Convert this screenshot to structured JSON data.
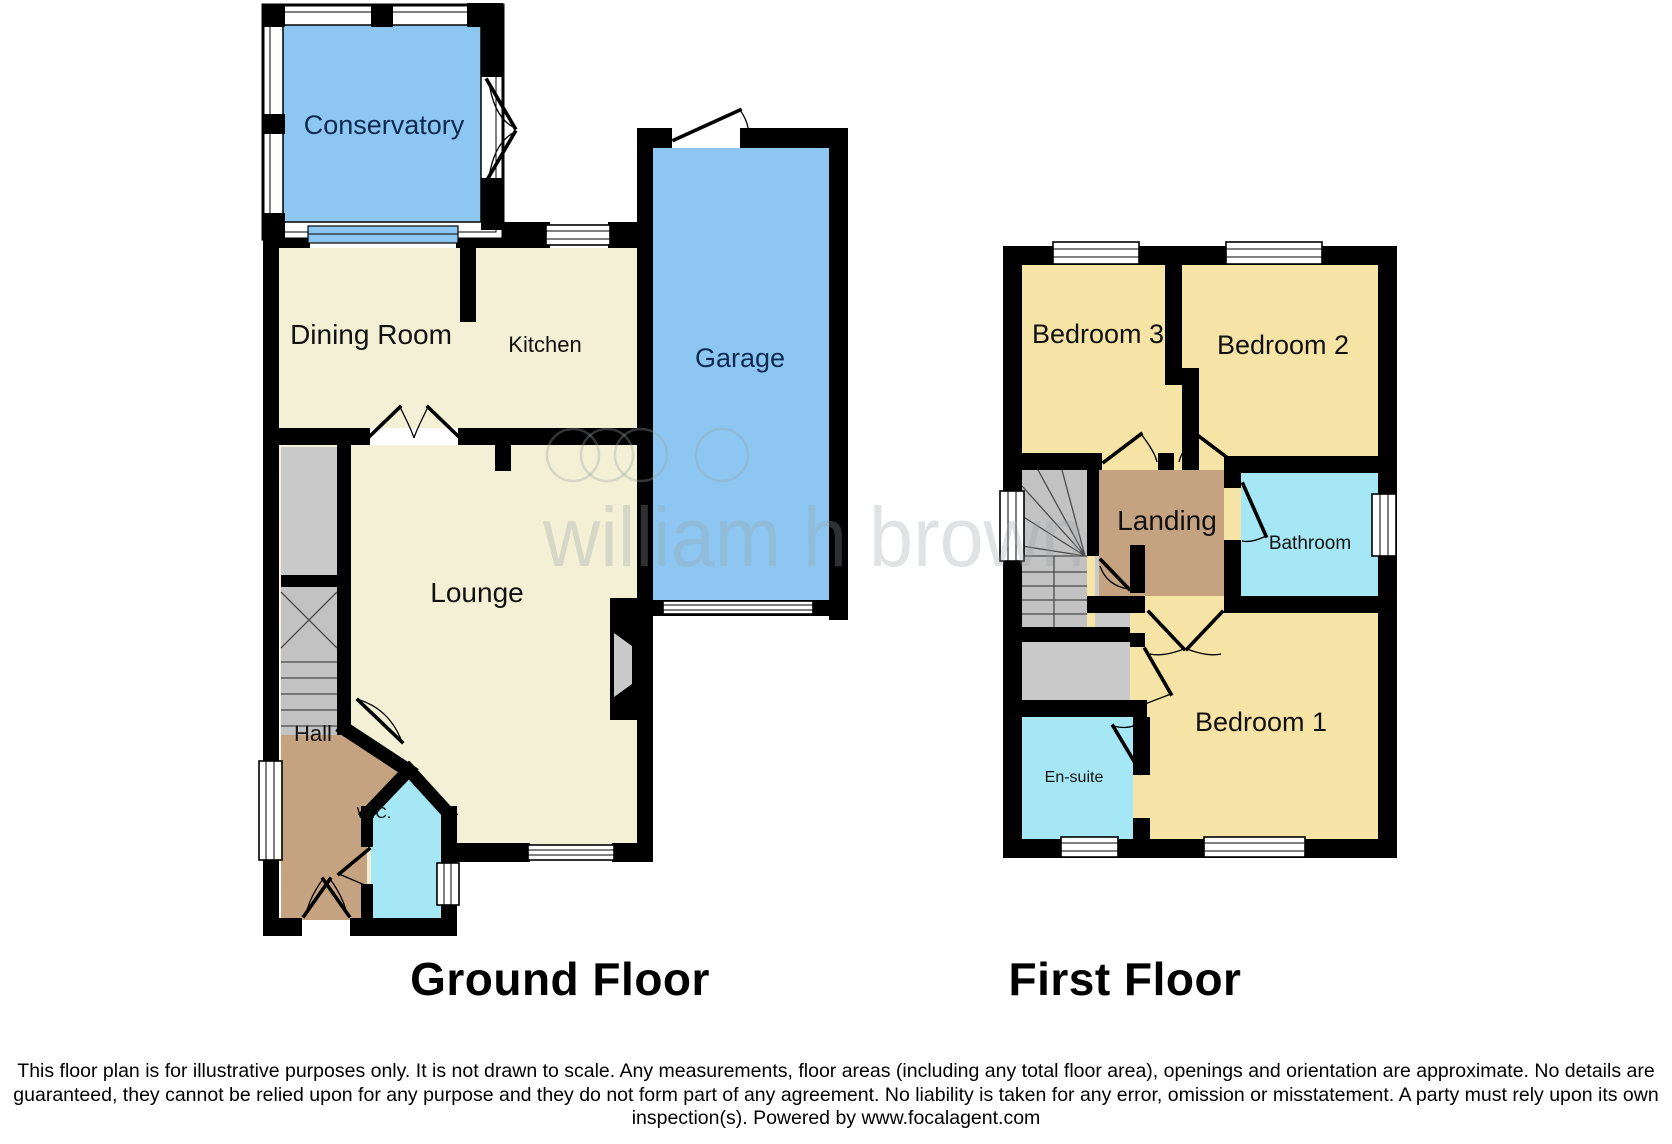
{
  "colors": {
    "room_blue": "#8dc7f1",
    "room_cream": "#f3f0d6",
    "room_gold": "#f6e3a6",
    "room_tan": "#c5a380",
    "room_cyan": "#a5e7f4",
    "stair_gray": "#c2c2c2",
    "closet_gray": "#c9c9c9",
    "wall_black": "#000000",
    "label_navy": "#0e2a52",
    "label_black": "#111111",
    "title_black": "#000000",
    "watermark_gray": "#9aa0a5"
  },
  "ground_floor": {
    "title": "Ground Floor",
    "rooms": {
      "conservatory": {
        "label": "Conservatory"
      },
      "dining_room": {
        "label": "Dining Room"
      },
      "kitchen": {
        "label": "Kitchen"
      },
      "garage": {
        "label": "Garage"
      },
      "lounge": {
        "label": "Lounge"
      },
      "hall": {
        "label": "Hall"
      },
      "wc": {
        "label": "W.C."
      }
    }
  },
  "first_floor": {
    "title": "First Floor",
    "rooms": {
      "bedroom3": {
        "label": "Bedroom 3"
      },
      "bedroom2": {
        "label": "Bedroom 2"
      },
      "landing": {
        "label": "Landing"
      },
      "bathroom": {
        "label": "Bathroom"
      },
      "bedroom1": {
        "label": "Bedroom 1"
      },
      "ensuite": {
        "label": "En-suite"
      }
    }
  },
  "watermark": {
    "text": "william h brown"
  },
  "disclaimer": "This floor plan is for illustrative purposes only. It is not drawn to scale. Any measurements, floor areas (including any total floor area), openings and orientation are approximate. No details are guaranteed, they cannot be relied upon for any purpose and they do not form part of any agreement. No liability is taken for any error, omission or misstatement. A party must rely upon its own inspection(s). Powered by www.focalagent.com"
}
